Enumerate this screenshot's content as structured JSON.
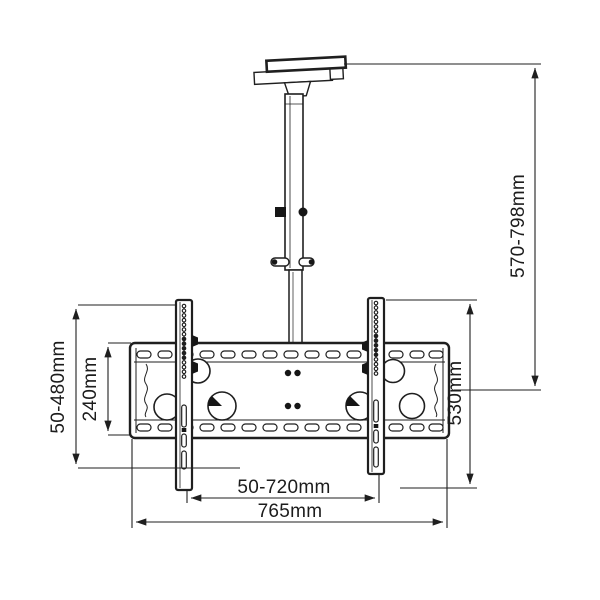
{
  "diagram": {
    "type": "technical-drawing",
    "subject": "ceiling tv mount bracket with telescopic pole",
    "background_color": "#ffffff",
    "line_color": "#1f1f1f",
    "dimensions": {
      "drop_height": "570-798mm",
      "rail_height": "530mm",
      "vesa_vertical_range": "50-480mm",
      "plate_height": "240mm",
      "vesa_horizontal_range": "50-720mm",
      "plate_width": "765mm"
    }
  }
}
